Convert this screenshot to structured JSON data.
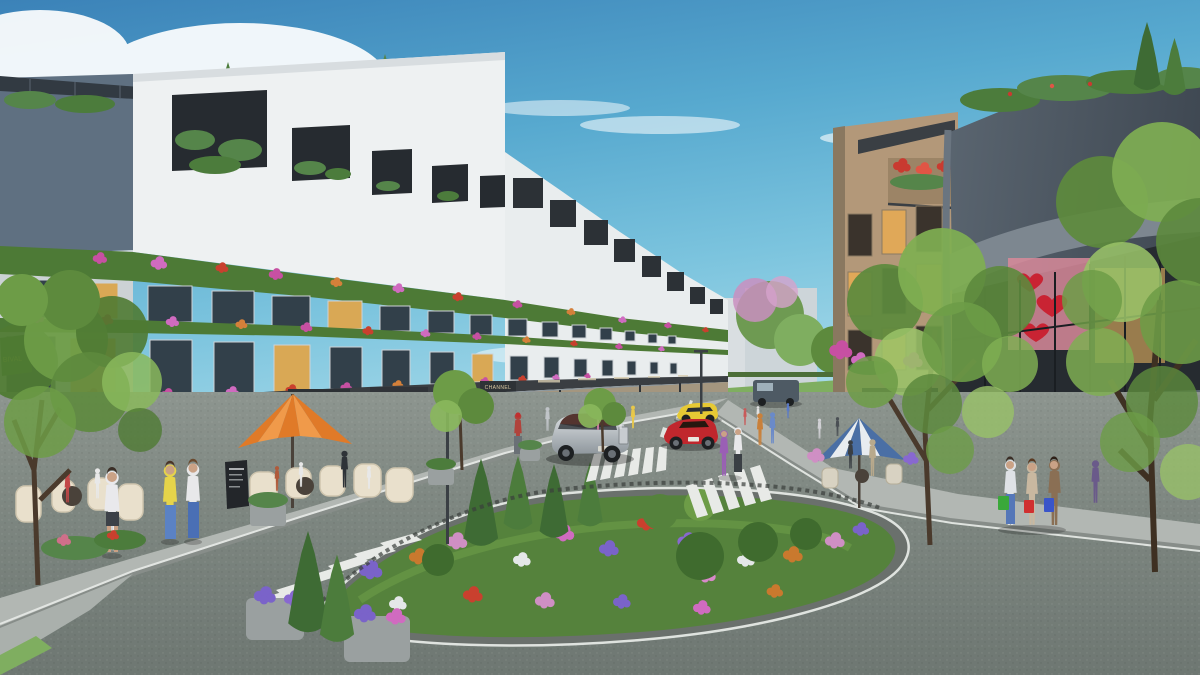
{
  "scene": {
    "title": "Shophouse retail streetscape - architectural 3D rendering",
    "type": "exterior-perspective-render",
    "time_of_day": "day",
    "weather": "sunny with scattered clouds"
  },
  "signs": {
    "calvin_klein": "CALVIN KLEIN",
    "stella_coffee": "STELLA COFFEE",
    "shenlong_line1": "SHENLONG",
    "shenlong_line2": "tea & juice",
    "channel": "CHANNEL",
    "channel_far": "CHANNEL",
    "christian_dior": "CHRISTIAN DIOR",
    "window_poster_partial": "BIVAL"
  },
  "palette": {
    "sky_top": "#3b82b8",
    "sky_horizon": "#cfeef4",
    "facade_white": "#eef1f2",
    "facade_tan": "#b39879",
    "facade_dark": "#49545f",
    "sign_band": "#2e3236",
    "sign_text_gold": "#dcc9a2",
    "dior_fascia": "#24282c",
    "bougainvillea_pink": "#c750a2",
    "flower_red": "#c9402e",
    "umbrella_orange": "#e07a28",
    "umbrella_blue_stripe": "#4a6fa5",
    "road_gray": "#7e8781",
    "island_green": "#55823c",
    "car_silver": "#c3c9cd",
    "car_red": "#c0272d",
    "car_yellow": "#e6c934"
  },
  "vehicles": [
    {
      "type": "luxury-sedan",
      "color": "silver"
    },
    {
      "type": "sports-car",
      "color": "red"
    },
    {
      "type": "sports-car",
      "color": "yellow"
    },
    {
      "type": "van",
      "color": "dark-gray"
    }
  ],
  "street_furniture": {
    "umbrella_left": "orange cantilever parasol",
    "umbrella_right": "blue and white striped parasol",
    "menu_board": "A-frame chalkboard",
    "roundabout": "landscaped garden island with cypress trees and flowers"
  }
}
